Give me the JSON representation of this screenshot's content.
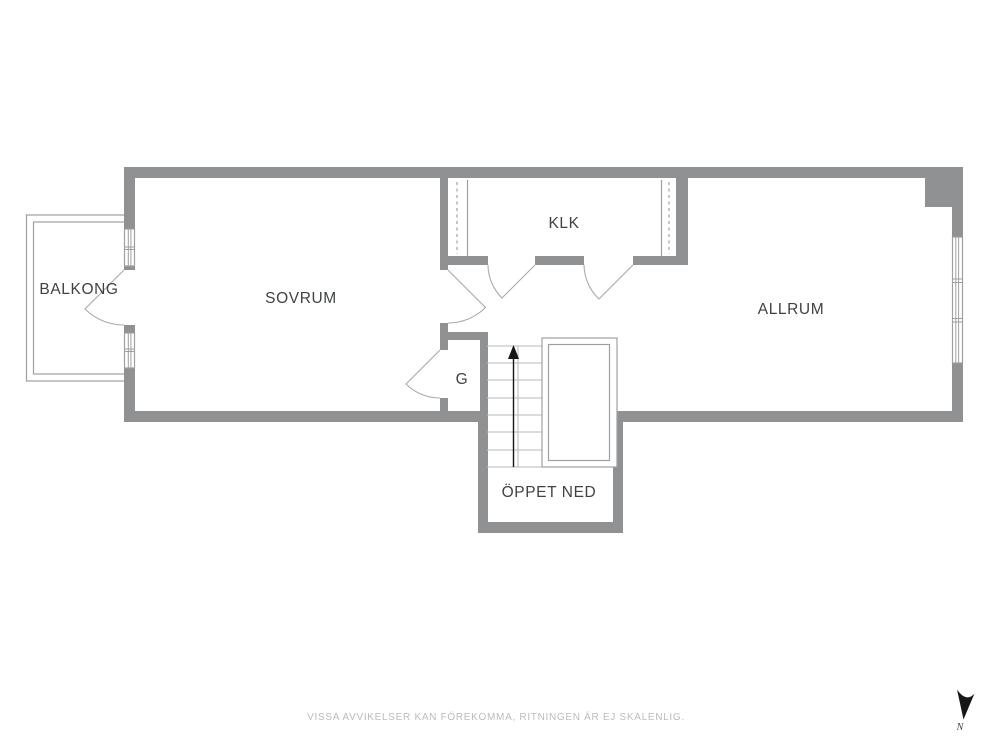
{
  "floorplan": {
    "rooms": {
      "balkong": {
        "label": "BALKONG"
      },
      "sovrum": {
        "label": "SOVRUM"
      },
      "klk": {
        "label": "KLK"
      },
      "allrum": {
        "label": "ALLRUM"
      },
      "garderob": {
        "label": "G"
      },
      "oppet_ned": {
        "label": "ÖPPET NED"
      }
    },
    "compass": {
      "north_label": "N"
    },
    "disclaimer": "VISSA AVVIKELSER KAN FÖREKOMMA, RITNINGEN ÄR EJ SKALENLIG."
  },
  "colors": {
    "background": "#ffffff",
    "wall": "#8f9193",
    "line": "#9da0a2",
    "light_line": "#b7babc",
    "door": "#a8abad",
    "text": "#3f4244",
    "muted": "#b9bcbe",
    "arrow": "#161616"
  }
}
